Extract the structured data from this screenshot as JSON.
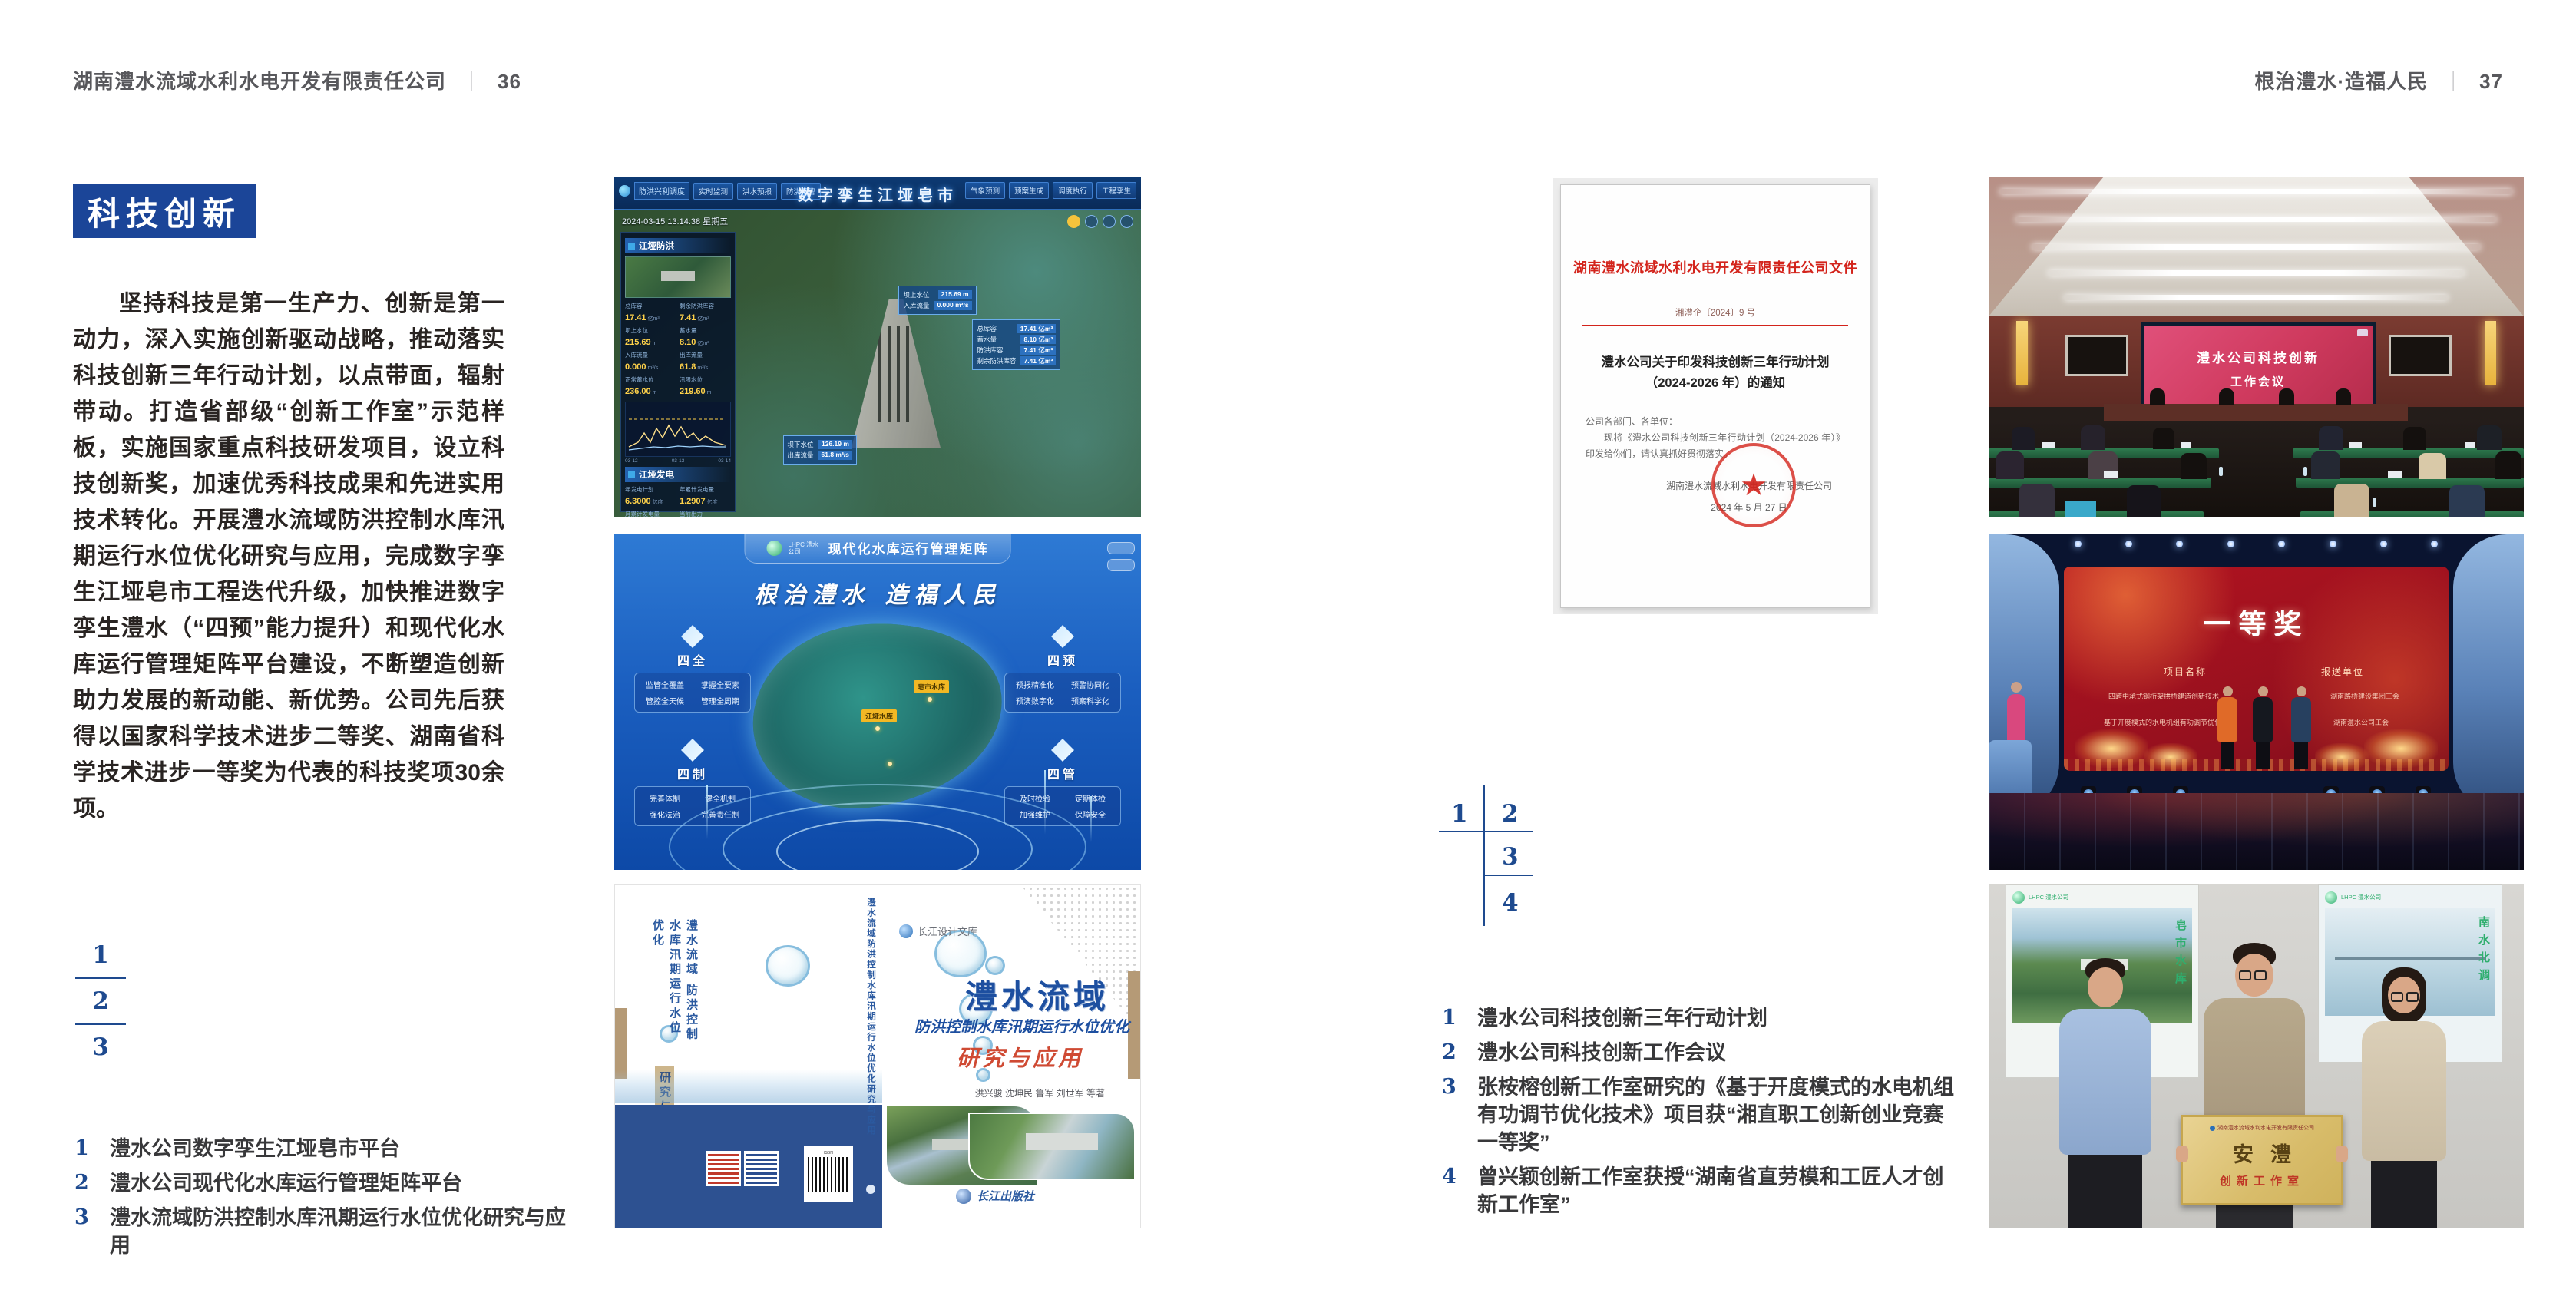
{
  "colors": {
    "accent_blue": "#1b4598",
    "index_blue": "#1e4a8f",
    "doc_red": "#d3241c"
  },
  "page_left": {
    "header": {
      "company": "湖南澧水流域水利水电开发有限责任公司",
      "divider": "｜",
      "page": "36"
    },
    "section_badge": "科技创新",
    "body_text": "坚持科技是第一生产力、创新是第一动力，深入实施创新驱动战略，推动落实科技创新三年行动计划，以点带面，辐射带动。打造省部级“创新工作室”示范样板，实施国家重点科技研发项目，设立科技创新奖，加速优秀科技成果和先进实用技术转化。开展澧水流域防洪控制水库汛期运行水位优化研究与应用，完成数字孪生江垭皂市工程迭代升级，加快推进数字孪生澧水（“四预”能力提升）和现代化水库运行管理矩阵平台建设，不断塑造创新助力发展的新动能、新优势。公司先后获得以国家科学技术进步二等奖、湖南省科学技术进步一等奖为代表的科技奖项30余项。",
    "index_numbers": [
      "1",
      "2",
      "3"
    ],
    "captions": [
      {
        "num": "1",
        "text": "澧水公司数字孪生江垭皂市平台"
      },
      {
        "num": "2",
        "text": "澧水公司现代化水库运行管理矩阵平台"
      },
      {
        "num": "3",
        "text": "澧水流域防洪控制水库汛期运行水位优化研究与应用"
      }
    ]
  },
  "page_right": {
    "header": {
      "motto": "根治澧水·造福人民",
      "divider": "｜",
      "page": "37"
    },
    "index_numbers": [
      "1",
      "2",
      "3",
      "4"
    ],
    "captions": [
      {
        "num": "1",
        "text": "澧水公司科技创新三年行动计划"
      },
      {
        "num": "2",
        "text": "澧水公司科技创新工作会议"
      },
      {
        "num": "3",
        "text": "张桉榕创新工作室研究的《基于开度模式的水电机组有功调节优化技术》项目获“湘直职工创新创业竞赛一等奖”"
      },
      {
        "num": "4",
        "text": "曾兴颖创新工作室获授“湖南省直劳模和工匠人才创新工作室”"
      }
    ]
  },
  "figures": {
    "dashboard": {
      "title": "数字孪生江垭皂市",
      "module": "防洪兴利调度",
      "nav_left": [
        "实时监测",
        "洪水预报",
        "防洪预警"
      ],
      "nav_right": [
        "气象预测",
        "预案生成",
        "调度执行",
        "工程孪生"
      ],
      "timestamp": "2024-03-15 13:14:38 星期五",
      "panel1_title": "江垭防洪",
      "panel1_stats": [
        {
          "label": "总库容",
          "value": "17.41",
          "unit": "亿m³"
        },
        {
          "label": "剩余防洪库容",
          "value": "7.41",
          "unit": "亿m³"
        },
        {
          "label": "坝上水位",
          "value": "215.69",
          "unit": "m"
        },
        {
          "label": "蓄水量",
          "value": "8.10",
          "unit": "亿m³"
        },
        {
          "label": "入库流量",
          "value": "0.000",
          "unit": "m³/s"
        },
        {
          "label": "出库流量",
          "value": "61.8",
          "unit": "m³/s"
        },
        {
          "label": "正常蓄水位",
          "value": "236.00",
          "unit": "m"
        },
        {
          "label": "汛限水位",
          "value": "219.60",
          "unit": "m"
        }
      ],
      "chart_x": [
        "03-12",
        "03-13",
        "03-14"
      ],
      "panel2_title": "江垭发电",
      "panel2_stats": [
        {
          "label": "年发电计划",
          "value": "6.3000",
          "unit": "亿度"
        },
        {
          "label": "年累计发电量",
          "value": "1.2907",
          "unit": "亿度"
        },
        {
          "label": "月累计发电量",
          "value": "3359.21",
          "unit": "万度"
        },
        {
          "label": "当前出力",
          "value": "0.00",
          "unit": "MW"
        },
        {
          "label": "发电流量",
          "value": "0.00",
          "unit": "m³/s"
        },
        {
          "label": "供水流量",
          "value": "0.00",
          "unit": "m³/s"
        }
      ],
      "unit_values": [
        "0.00",
        "102.98",
        "0.00"
      ],
      "unit_labels": [
        "1#机组",
        "2#机组",
        "3#机组"
      ],
      "callout1": [
        {
          "label": "坝上水位",
          "value": "215.69 m"
        },
        {
          "label": "入库流量",
          "value": "0.000 m³/s"
        }
      ],
      "callout2": [
        {
          "label": "总库容",
          "value": "17.41 亿m³"
        },
        {
          "label": "蓄水量",
          "value": "8.10 亿m³"
        },
        {
          "label": "防洪库容",
          "value": "7.41 亿m³"
        },
        {
          "label": "剩余防洪库容",
          "value": "7.41 亿m³"
        }
      ],
      "callout3": [
        {
          "label": "坝下水位",
          "value": "126.19 m"
        },
        {
          "label": "出库流量",
          "value": "61.8 m³/s"
        }
      ]
    },
    "matrix": {
      "logo_text": "LHPC 澧水公司",
      "title": "现代化水库运行管理矩阵",
      "slogan": "根治澧水  造福人民",
      "groups": [
        {
          "name": "四全",
          "items": [
            "监管全覆盖",
            "掌握全要素",
            "管控全天候",
            "管理全周期"
          ]
        },
        {
          "name": "四预",
          "items": [
            "预报精准化",
            "预警协同化",
            "预演数字化",
            "预案科学化"
          ]
        },
        {
          "name": "四制",
          "items": [
            "完善体制",
            "健全机制",
            "强化法治",
            "完善责任制"
          ]
        },
        {
          "name": "四管",
          "items": [
            "及时检验",
            "定期体检",
            "加强维护",
            "保障安全"
          ]
        }
      ],
      "map_label_1": "皂市水库",
      "map_label_2": "江垭水库"
    },
    "book": {
      "series": "长江设计文库",
      "back_title": "澧水流域 防洪控制水库汛期运行水位优化",
      "back_tail": "研究与应用",
      "spine_text": "澧水流域防洪控制水库汛期运行水位优化研究与应用",
      "title_main": "澧水流域",
      "title_sub": "防洪控制水库汛期运行水位优化",
      "title_tail": "研究与应用",
      "authors": "洪兴骏  沈坤民  鲁军  刘世军  等著",
      "publisher": "长江出版社"
    },
    "document": {
      "header": "湖南澧水流域水利水电开发有限责任公司文件",
      "doc_no": "湘澧企〔2024〕9 号",
      "title_line1": "澧水公司关于印发科技创新三年行动计划",
      "title_line2": "（2024-2026 年）的通知",
      "salutation": "公司各部门、各单位：",
      "body": "现将《澧水公司科技创新三年行动计划（2024-2026 年）》印发给你们，请认真抓好贯彻落实。",
      "signer": "湖南澧水流域水利水电开发有限责任公司",
      "date": "2024 年 5 月 27 日",
      "seal_star": "★"
    },
    "meeting": {
      "screen_line1": "澧水公司科技创新",
      "screen_line2": "工作会议"
    },
    "stage": {
      "award": "一等奖",
      "col1_header": "项目名称",
      "col2_header": "报送单位",
      "rows": [
        [
          "四跨中承式钢桁架拱桥建造创新技术",
          "湖南路桥建设集团工会"
        ],
        [
          "基于开度模式的水电机组有功调节优化技术",
          "湖南澧水公司工会"
        ]
      ]
    },
    "group_photo": {
      "poster_logo_text": "LHPC 澧水公司",
      "poster_left_vtext": "皂市水库",
      "poster_right_vtext": "南水北调",
      "plaque_org": "湖南澧水流域水利水电开发有限责任公司",
      "plaque_name": "安澧",
      "plaque_subtitle": "创新工作室"
    }
  }
}
